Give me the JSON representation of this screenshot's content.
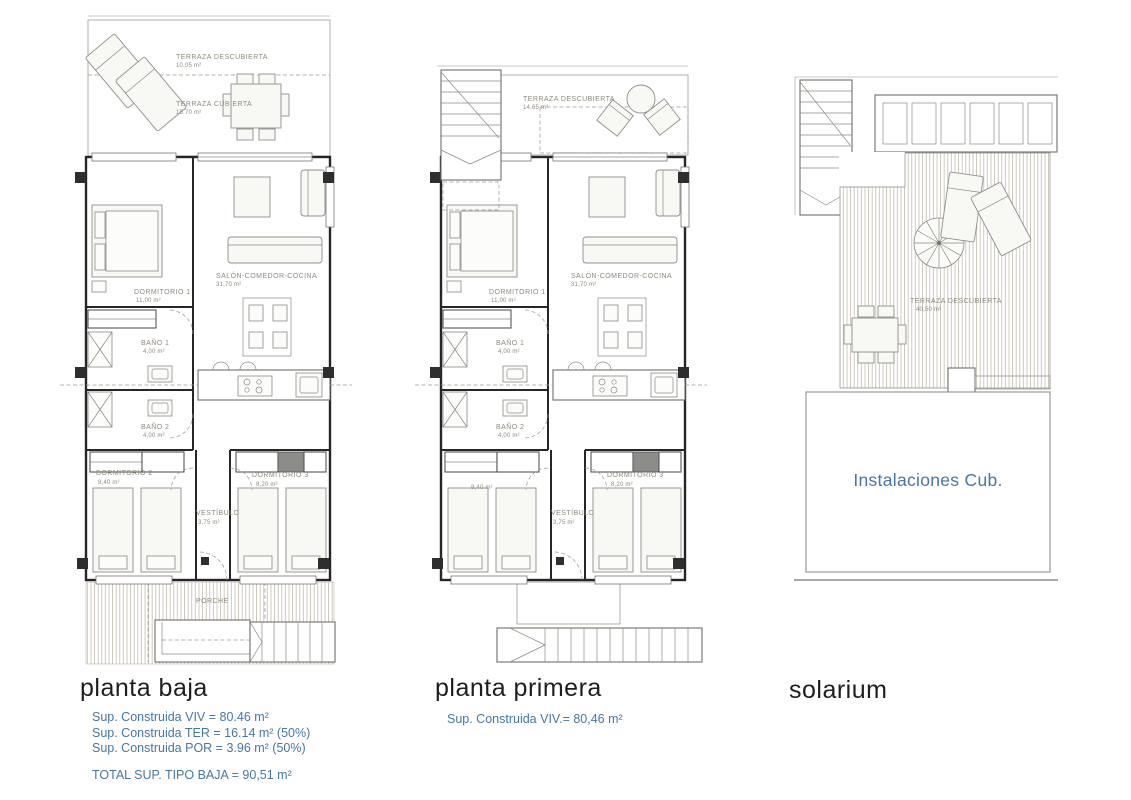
{
  "colors": {
    "accent_blue": "#4577a5",
    "wall": "#262626",
    "hatch_line": "#bcb4a4",
    "label_gray": "#8f8a7d",
    "title_color": "#1e1e1e"
  },
  "plans": {
    "baja": {
      "title": "planta baja",
      "labels": {
        "terraza_descubierta": "TERRAZA DESCUBIERTA",
        "terraza_descubierta_area": "10,05 m²",
        "terraza_cubierta": "TERRAZA CUBIERTA",
        "terraza_cubierta_area": "15,70 m²",
        "dormitorio1": "DORMITORIO 1",
        "dormitorio1_area": "11,00 m²",
        "salon": "SALÓN-COMEDOR-COCINA",
        "salon_area": "31,70 m²",
        "bano1": "BAÑO 1",
        "bano1_area": "4,00 m²",
        "bano2": "BAÑO 2",
        "bano2_area": "4,00 m²",
        "dormitorio2": "DORMITORIO 2",
        "dormitorio2_area": "8,40 m²",
        "dormitorio3": "DORMITORIO 3",
        "dormitorio3_area": "8,20 m²",
        "vestibulo": "VESTÍBULO",
        "vestibulo_area": "3,75 m²",
        "porche": "PORCHE"
      },
      "summary": [
        "Sup. Construida VIV = 80.46 m²",
        "Sup. Construida TER = 16.14 m² (50%)",
        "Sup. Construida POR = 3.96 m² (50%)"
      ],
      "total": "TOTAL SUP. TIPO BAJA = 90,51 m²"
    },
    "primera": {
      "title": "planta primera",
      "labels": {
        "terraza_descubierta": "TERRAZA DESCUBIERTA",
        "terraza_descubierta_area": "14,65 m²",
        "dormitorio1": "DORMITORIO 1",
        "dormitorio1_area": "11,00 m²",
        "salon": "SALÓN-COMEDOR-COCINA",
        "salon_area": "31,70 m²",
        "bano1": "BAÑO 1",
        "bano1_area": "4,00 m²",
        "bano2": "BAÑO 2",
        "bano2_area": "4,00 m²",
        "dormitorio2_area": "8,40 m²",
        "dormitorio3": "DORMITORIO 3",
        "dormitorio3_area": "8,20 m²",
        "vestibulo": "VESTÍBULO",
        "vestibulo_area": "3,75 m²"
      },
      "summary": [
        "Sup. Construida VIV.= 80,46 m²"
      ]
    },
    "solarium": {
      "title": "solarium",
      "labels": {
        "terraza_descubierta": "TERRAZA DESCUBIERTA",
        "terraza_descubierta_area": "40,50 m²",
        "instalaciones": "Instalaciones Cub."
      }
    }
  }
}
